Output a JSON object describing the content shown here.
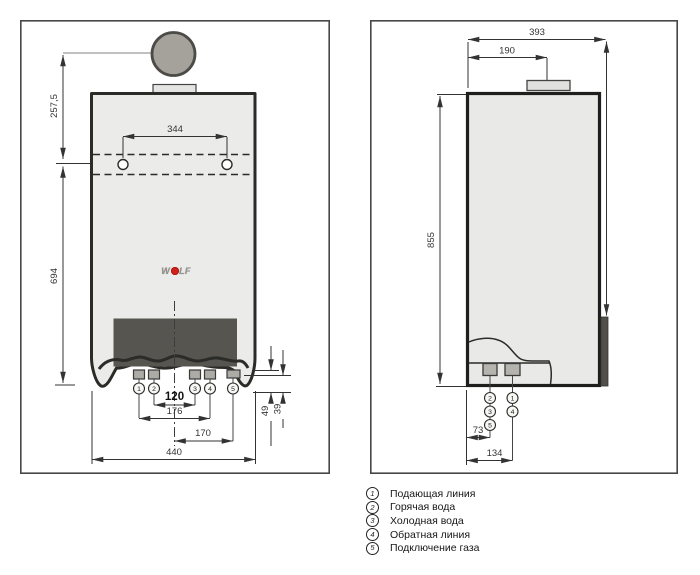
{
  "front": {
    "dims": {
      "offset_top": "257,5",
      "height": "694",
      "hole_spacing": "344",
      "pair_center": "120",
      "pair_outer": "176",
      "gas_offset": "170",
      "total_width": "440",
      "proj_a": "49",
      "proj_b": "39"
    },
    "connections": [
      "1",
      "2",
      "3",
      "4",
      "5"
    ]
  },
  "side": {
    "dims": {
      "total_depth": "393",
      "flue_offset": "190",
      "height": "855",
      "offset_a": "73",
      "offset_b": "134"
    },
    "connections_col1": [
      "2",
      "3",
      "5"
    ],
    "connections_col2": [
      "1",
      "4"
    ]
  },
  "logo": {
    "prefix": "W",
    "suffix": "LF"
  },
  "legend": {
    "items": [
      {
        "num": "1",
        "label": "Подающая линия"
      },
      {
        "num": "2",
        "label": "Горячая вода"
      },
      {
        "num": "3",
        "label": "Холодная вода"
      },
      {
        "num": "4",
        "label": "Обратная линия"
      },
      {
        "num": "5",
        "label": "Подключение газа"
      }
    ]
  },
  "colors": {
    "line": "#2b2b28",
    "casing_fill": "#ebebe9",
    "panel_dark": "#56554f",
    "flue_gray": "#a5a29b",
    "accent_red": "#d0201c"
  }
}
